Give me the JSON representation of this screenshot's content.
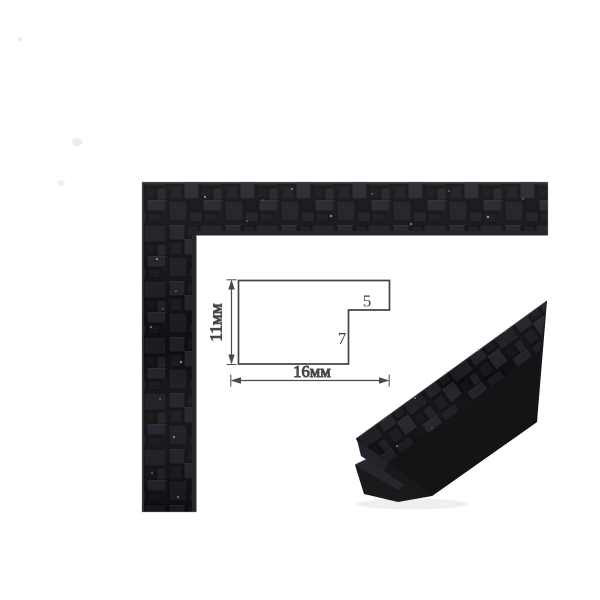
{
  "background_color": "#ffffff",
  "diagram": {
    "height_label": "11мм",
    "width_label": "16мм",
    "step_width_label": "5",
    "step_height_label": "7",
    "line_color": "#454545",
    "text_color": "#3b3b3b"
  },
  "moulding": {
    "base_color": "#18181b",
    "finish_color": "#1d1d21",
    "texture_name": "black-mosaic-squares"
  }
}
